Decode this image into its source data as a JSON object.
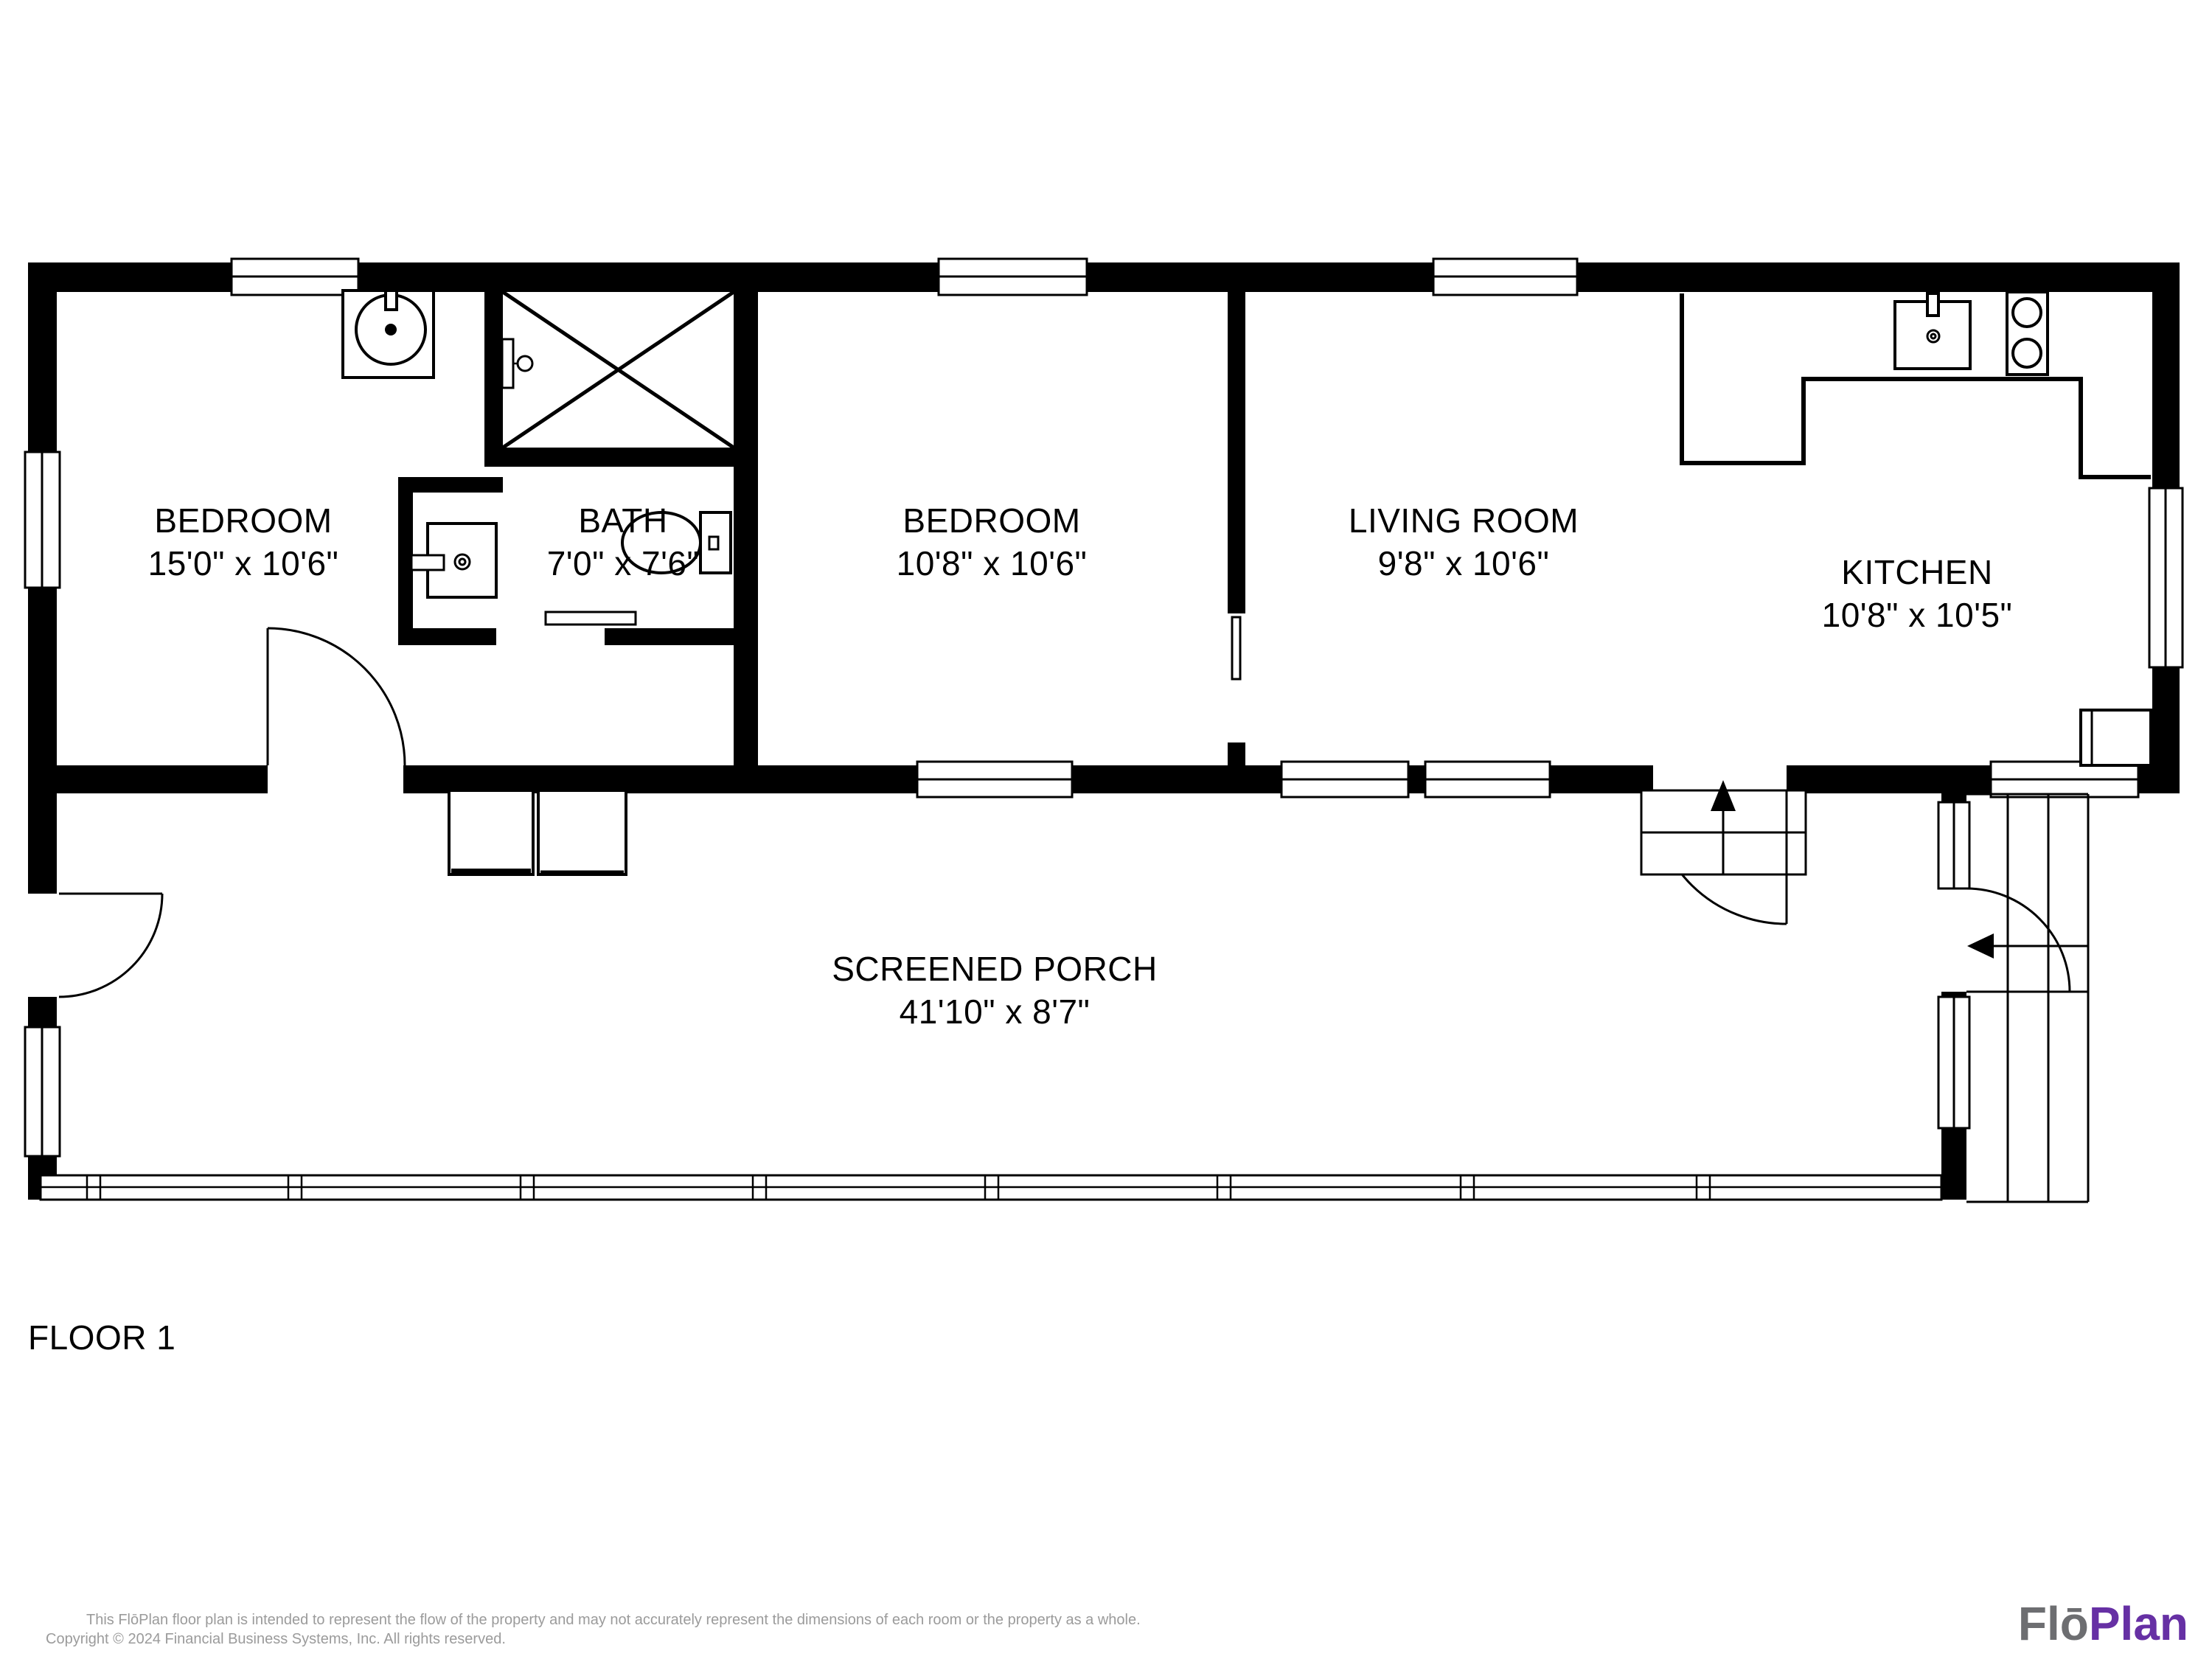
{
  "floor_plan": {
    "floor_label": "FLOOR 1",
    "rooms": [
      {
        "name": "BEDROOM",
        "dims": "15'0\" x 10'6\""
      },
      {
        "name": "BATH",
        "dims": "7'0\" x 7'6\""
      },
      {
        "name": "BEDROOM",
        "dims": "10'8\" x 10'6\""
      },
      {
        "name": "LIVING ROOM",
        "dims": "9'8\" x 10'6\""
      },
      {
        "name": "KITCHEN",
        "dims": "10'8\" x 10'5\""
      },
      {
        "name": "SCREENED PORCH",
        "dims": "41'10\" x 8'7\""
      }
    ]
  },
  "footer": {
    "disclaimer_line1": "This FlōPlan floor plan is intended to represent the flow of the property and may not accurately represent the dimensions of each room or the property as a whole.",
    "disclaimer_line2": "Copyright © 2024 Financial Business Systems, Inc. All rights reserved."
  },
  "branding": {
    "logo_part1": "Flō",
    "logo_part2": "Plan"
  },
  "colors": {
    "wall": "#000000",
    "disclaimer_gray": "#9b9b9b",
    "logo_gray": "#6d6e71",
    "logo_purple": "#6630a4"
  }
}
